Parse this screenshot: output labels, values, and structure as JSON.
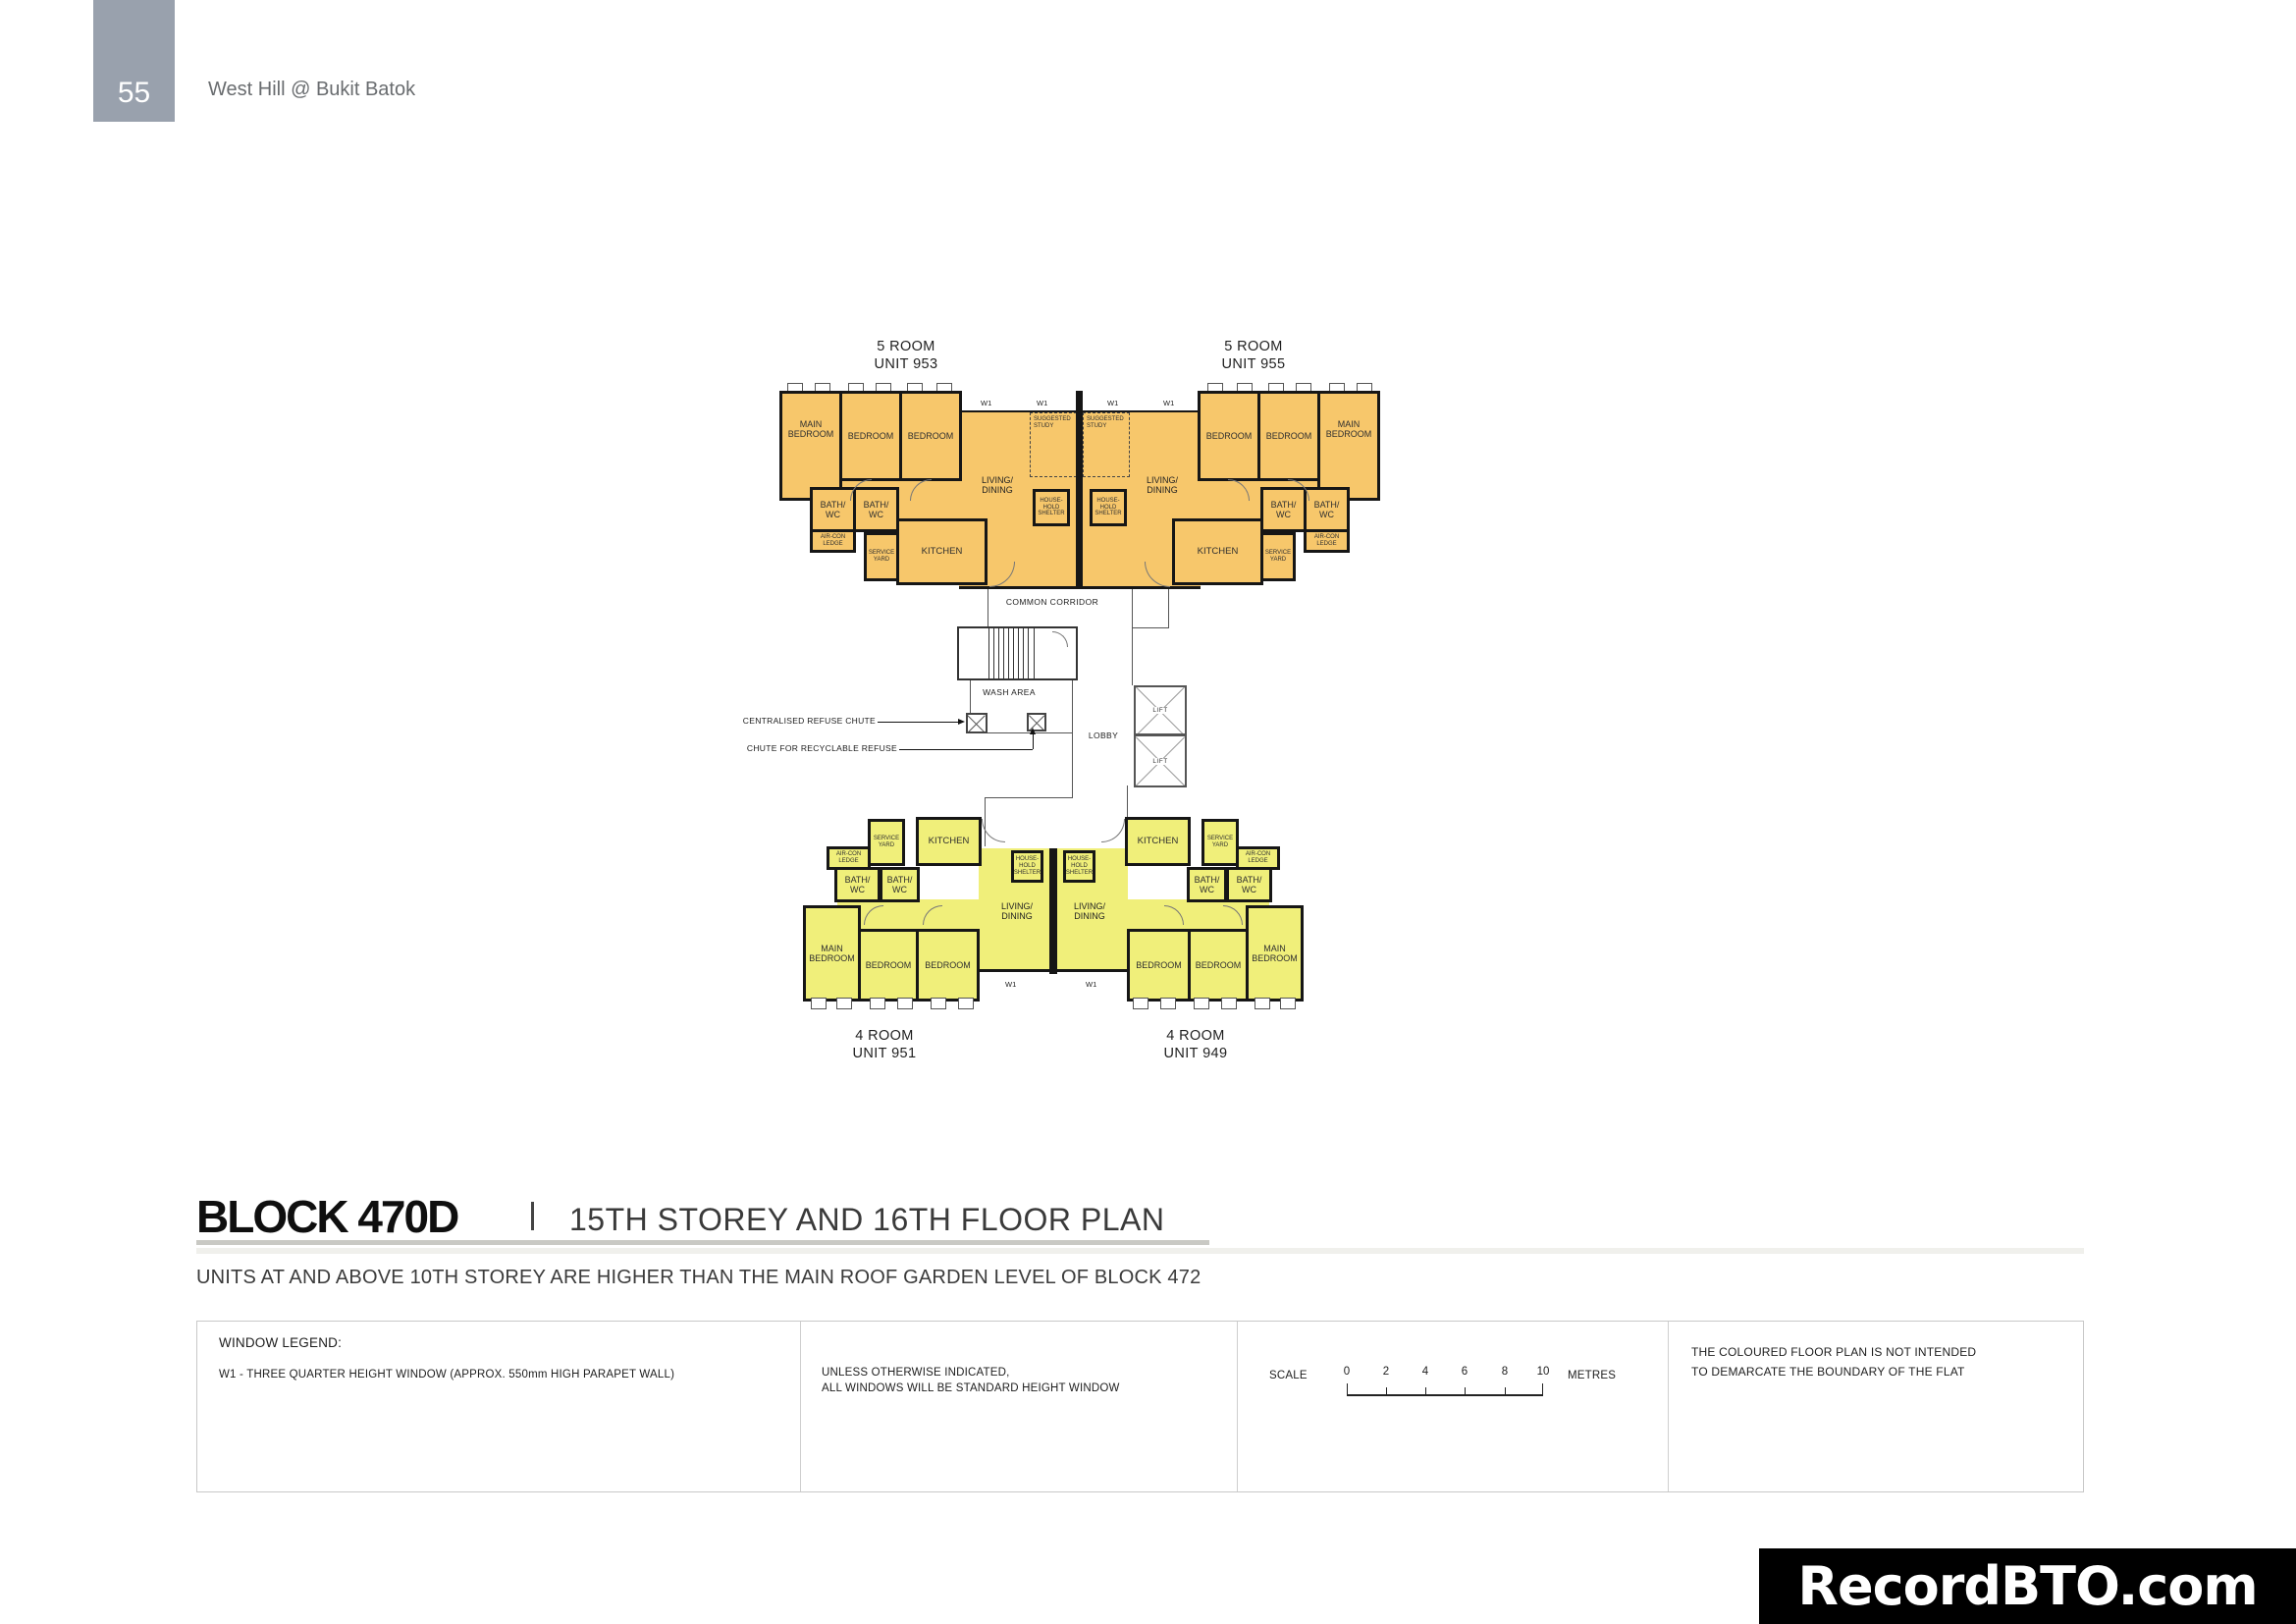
{
  "page": {
    "number": "55",
    "project": "West Hill @ Bukit Batok"
  },
  "heading": {
    "block": "BLOCK 470D",
    "title": "15TH STOREY AND 16TH FLOOR PLAN",
    "note": "UNITS AT AND ABOVE 10TH STOREY ARE HIGHER THAN THE MAIN ROOF GARDEN LEVEL OF BLOCK 472"
  },
  "units": {
    "top_left": {
      "type": "5 ROOM",
      "number": "UNIT 953"
    },
    "top_right": {
      "type": "5 ROOM",
      "number": "UNIT 955"
    },
    "bottom_left": {
      "type": "4 ROOM",
      "number": "UNIT 951"
    },
    "bottom_right": {
      "type": "4 ROOM",
      "number": "UNIT 949"
    }
  },
  "rooms": {
    "main_bedroom": "MAIN BEDROOM",
    "bedroom": "BEDROOM",
    "living_dining": "LIVING/ DINING",
    "kitchen": "KITCHEN",
    "bath_wc": "BATH/ WC",
    "aircon_ledge": "AIR-CON LEDGE",
    "service_yard": "SERVICE YARD",
    "household_shelter": "HOUSE- HOLD SHELTER",
    "suggested_study": "SUGGESTED STUDY",
    "window_tag": "W1"
  },
  "core": {
    "common_corridor": "COMMON CORRIDOR",
    "wash_area": "WASH AREA",
    "lobby": "LOBBY",
    "lift": "LIFT",
    "centralised_refuse_chute": "CENTRALISED REFUSE CHUTE",
    "recyclable_refuse_chute": "CHUTE FOR RECYCLABLE REFUSE"
  },
  "legend": {
    "window_title": "WINDOW LEGEND:",
    "window_item": "W1 - THREE QUARTER HEIGHT WINDOW (APPROX. 550mm HIGH PARAPET WALL)",
    "note_line1": "UNLESS OTHERWISE INDICATED,",
    "note_line2": "ALL WINDOWS WILL BE STANDARD HEIGHT WINDOW",
    "scale": {
      "label": "SCALE",
      "ticks": [
        "0",
        "2",
        "4",
        "6",
        "8",
        "10"
      ],
      "unit": "METRES"
    },
    "boundary_line1": "THE COLOURED FLOOR PLAN IS NOT INTENDED",
    "boundary_line2": "TO DEMARCATE THE BOUNDARY OF THE FLAT"
  },
  "watermark": {
    "text": "RecordBTO.com"
  },
  "colors": {
    "five_room": "#F7C76B",
    "four_room": "#F0EF7A",
    "wall": "#161616",
    "page_tab": "#99A1AD"
  }
}
